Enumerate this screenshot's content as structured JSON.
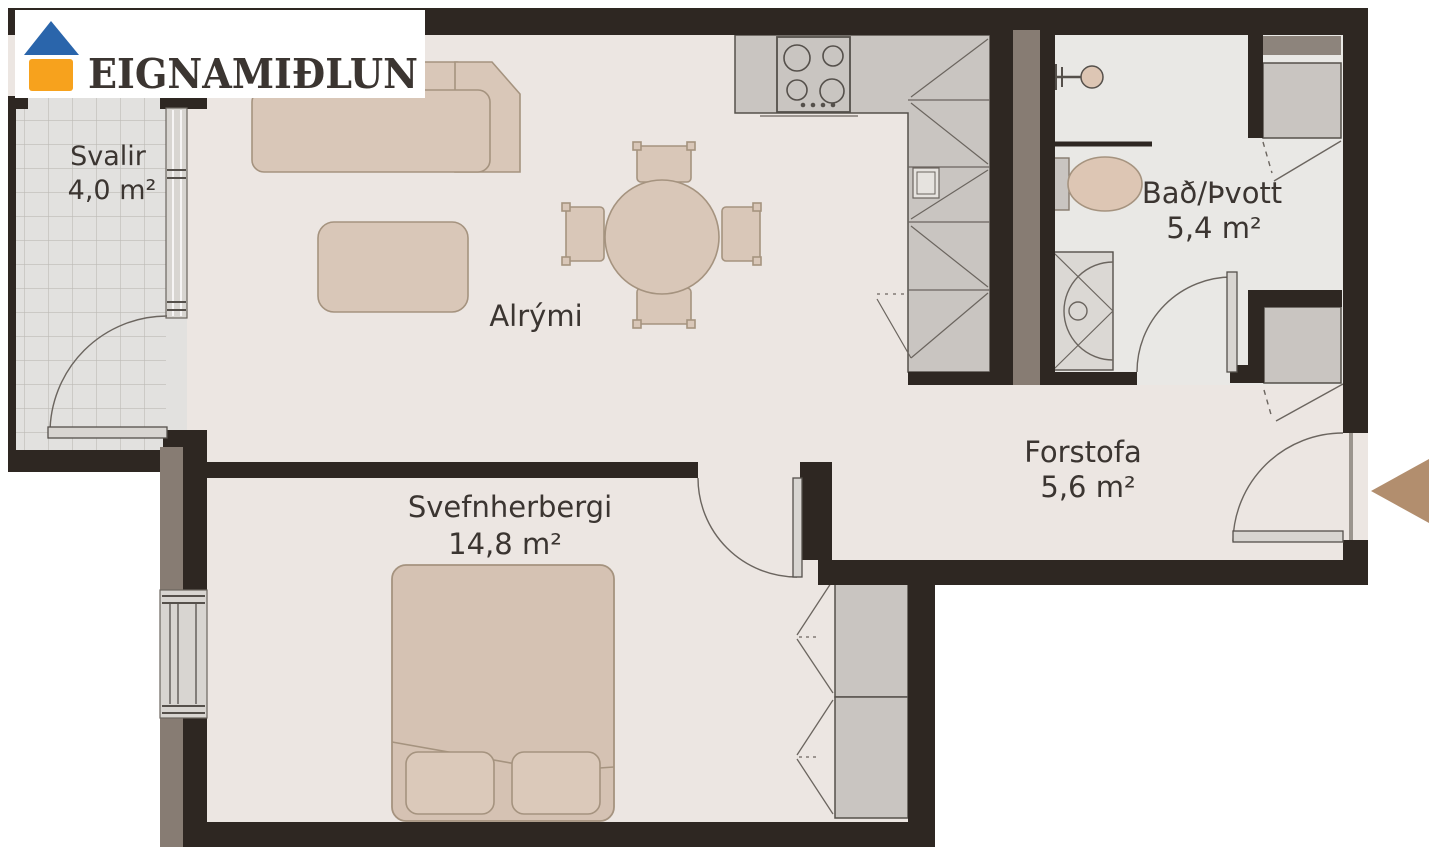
{
  "logo": {
    "brand": "EIGNAMIÐLUN",
    "icon": "house-icon",
    "roof_color": "#2a65ab",
    "body_color": "#f7a21d",
    "text_color": "#1d4f94"
  },
  "rooms": {
    "svalir": {
      "name": "Svalir",
      "area": "4,0 m²"
    },
    "alrymi": {
      "name": "Alrými",
      "area": ""
    },
    "bad": {
      "name": "Bað/Þvott",
      "area": "5,4 m²"
    },
    "forstofa": {
      "name": "Forstofa",
      "area": "5,6 m²"
    },
    "svefnherbergi": {
      "name": "Svefnherbergi",
      "area": "14,8 m²"
    }
  },
  "entrance": {
    "icon": "entry-arrow-icon",
    "color": "#b28e6e"
  },
  "colors": {
    "wall": "#2e2722",
    "wall_outer": "#877c73",
    "floor_main": "#ece6e2",
    "floor_bath": "#e9e8e5",
    "floor_balcony": "#e2e1df",
    "furniture": "#d9c7b8",
    "cabinet_gray": "#c9c5c1",
    "label_text": "#3b3531"
  }
}
